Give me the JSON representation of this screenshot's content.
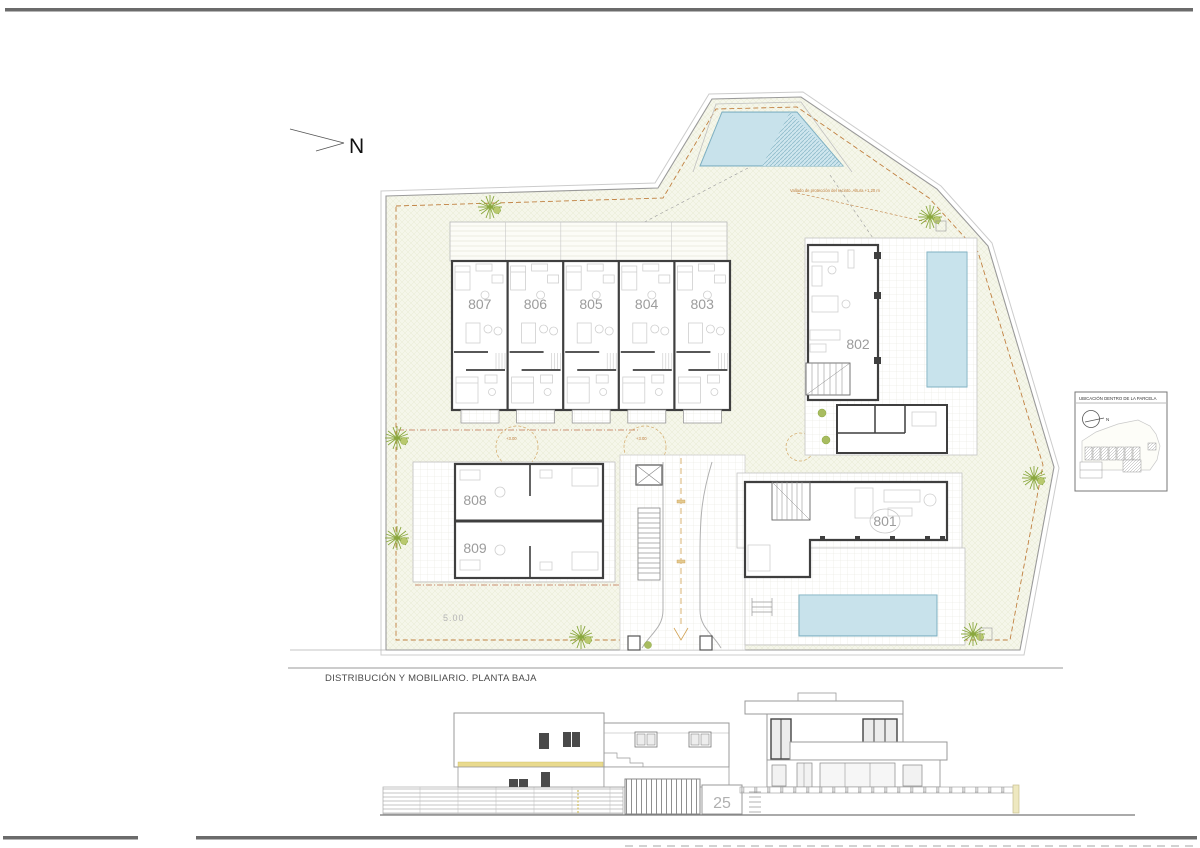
{
  "sheet": {
    "caption": "DISTRIBUCIÓN Y MOBILIARIO. PLANTA BAJA",
    "house_number": "25"
  },
  "compass": {
    "label": "N"
  },
  "plan": {
    "units": [
      {
        "label": "807"
      },
      {
        "label": "806"
      },
      {
        "label": "805"
      },
      {
        "label": "804"
      },
      {
        "label": "803"
      },
      {
        "label": "802"
      },
      {
        "label": "808"
      },
      {
        "label": "809"
      },
      {
        "label": "801"
      }
    ],
    "annotations": {
      "fence_note": "Vallado de protección del recinto. Altura +1,20 m",
      "dim_front": "5.00",
      "level_patio_1": "+3.00",
      "level_patio_2": "+3.00"
    }
  },
  "inset": {
    "title": "UBICACIÓN DENTRO DE LA PARCELA",
    "north_label": "N"
  },
  "colors": {
    "plot_fill": "#f5f6ea",
    "boundary_dash": "#c08040",
    "wall": "#3f3f3f",
    "pool_fill": "#daeef4",
    "pool_line": "#a9cfdc",
    "tree_green": "#8aa83e",
    "label_gray": "#9c9c9c",
    "accent_band_yellow": "#e9da8e",
    "border_line": "#6b6b6b"
  }
}
